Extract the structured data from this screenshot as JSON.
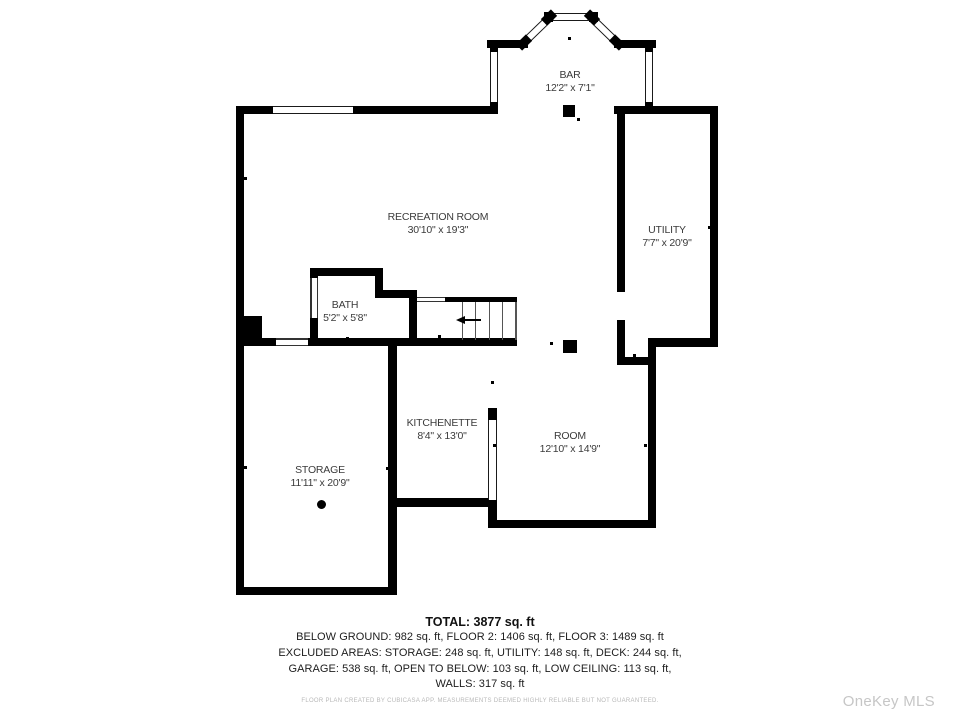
{
  "plan": {
    "rooms": [
      {
        "id": "bar",
        "name": "BAR",
        "dims": "12'2\" x 7'1\""
      },
      {
        "id": "recreation",
        "name": "RECREATION ROOM",
        "dims": "30'10\" x 19'3\""
      },
      {
        "id": "utility",
        "name": "UTILITY",
        "dims": "7'7\" x 20'9\""
      },
      {
        "id": "bath",
        "name": "BATH",
        "dims": "5'2\" x 5'8\""
      },
      {
        "id": "kitchenette",
        "name": "KITCHENETTE",
        "dims": "8'4\" x 13'0\""
      },
      {
        "id": "room",
        "name": "ROOM",
        "dims": "12'10\" x 14'9\""
      },
      {
        "id": "storage",
        "name": "STORAGE",
        "dims": "11'11\" x 20'9\""
      }
    ]
  },
  "summary": {
    "total": "TOTAL: 3877 sq. ft",
    "lines": [
      "BELOW GROUND: 982 sq. ft, FLOOR 2: 1406 sq. ft, FLOOR 3: 1489 sq. ft",
      "EXCLUDED AREAS: STORAGE: 248 sq. ft, UTILITY: 148 sq. ft, DECK: 244 sq. ft,",
      "GARAGE: 538 sq. ft, OPEN TO BELOW: 103 sq. ft, LOW CEILING: 113 sq. ft,",
      "WALLS: 317 sq. ft"
    ],
    "disclaimer": "FLOOR PLAN CREATED BY CUBICASA APP. MEASUREMENTS DEEMED HIGHLY RELIABLE BUT NOT GUARANTEED.",
    "watermark": "OneKey MLS"
  },
  "colors": {
    "wall": "#000000",
    "label": "#3b3b3b",
    "summary_text": "#1d1d1d",
    "disclaimer": "#b8b8b8",
    "watermark": "#c6c6c6",
    "background": "#ffffff"
  }
}
